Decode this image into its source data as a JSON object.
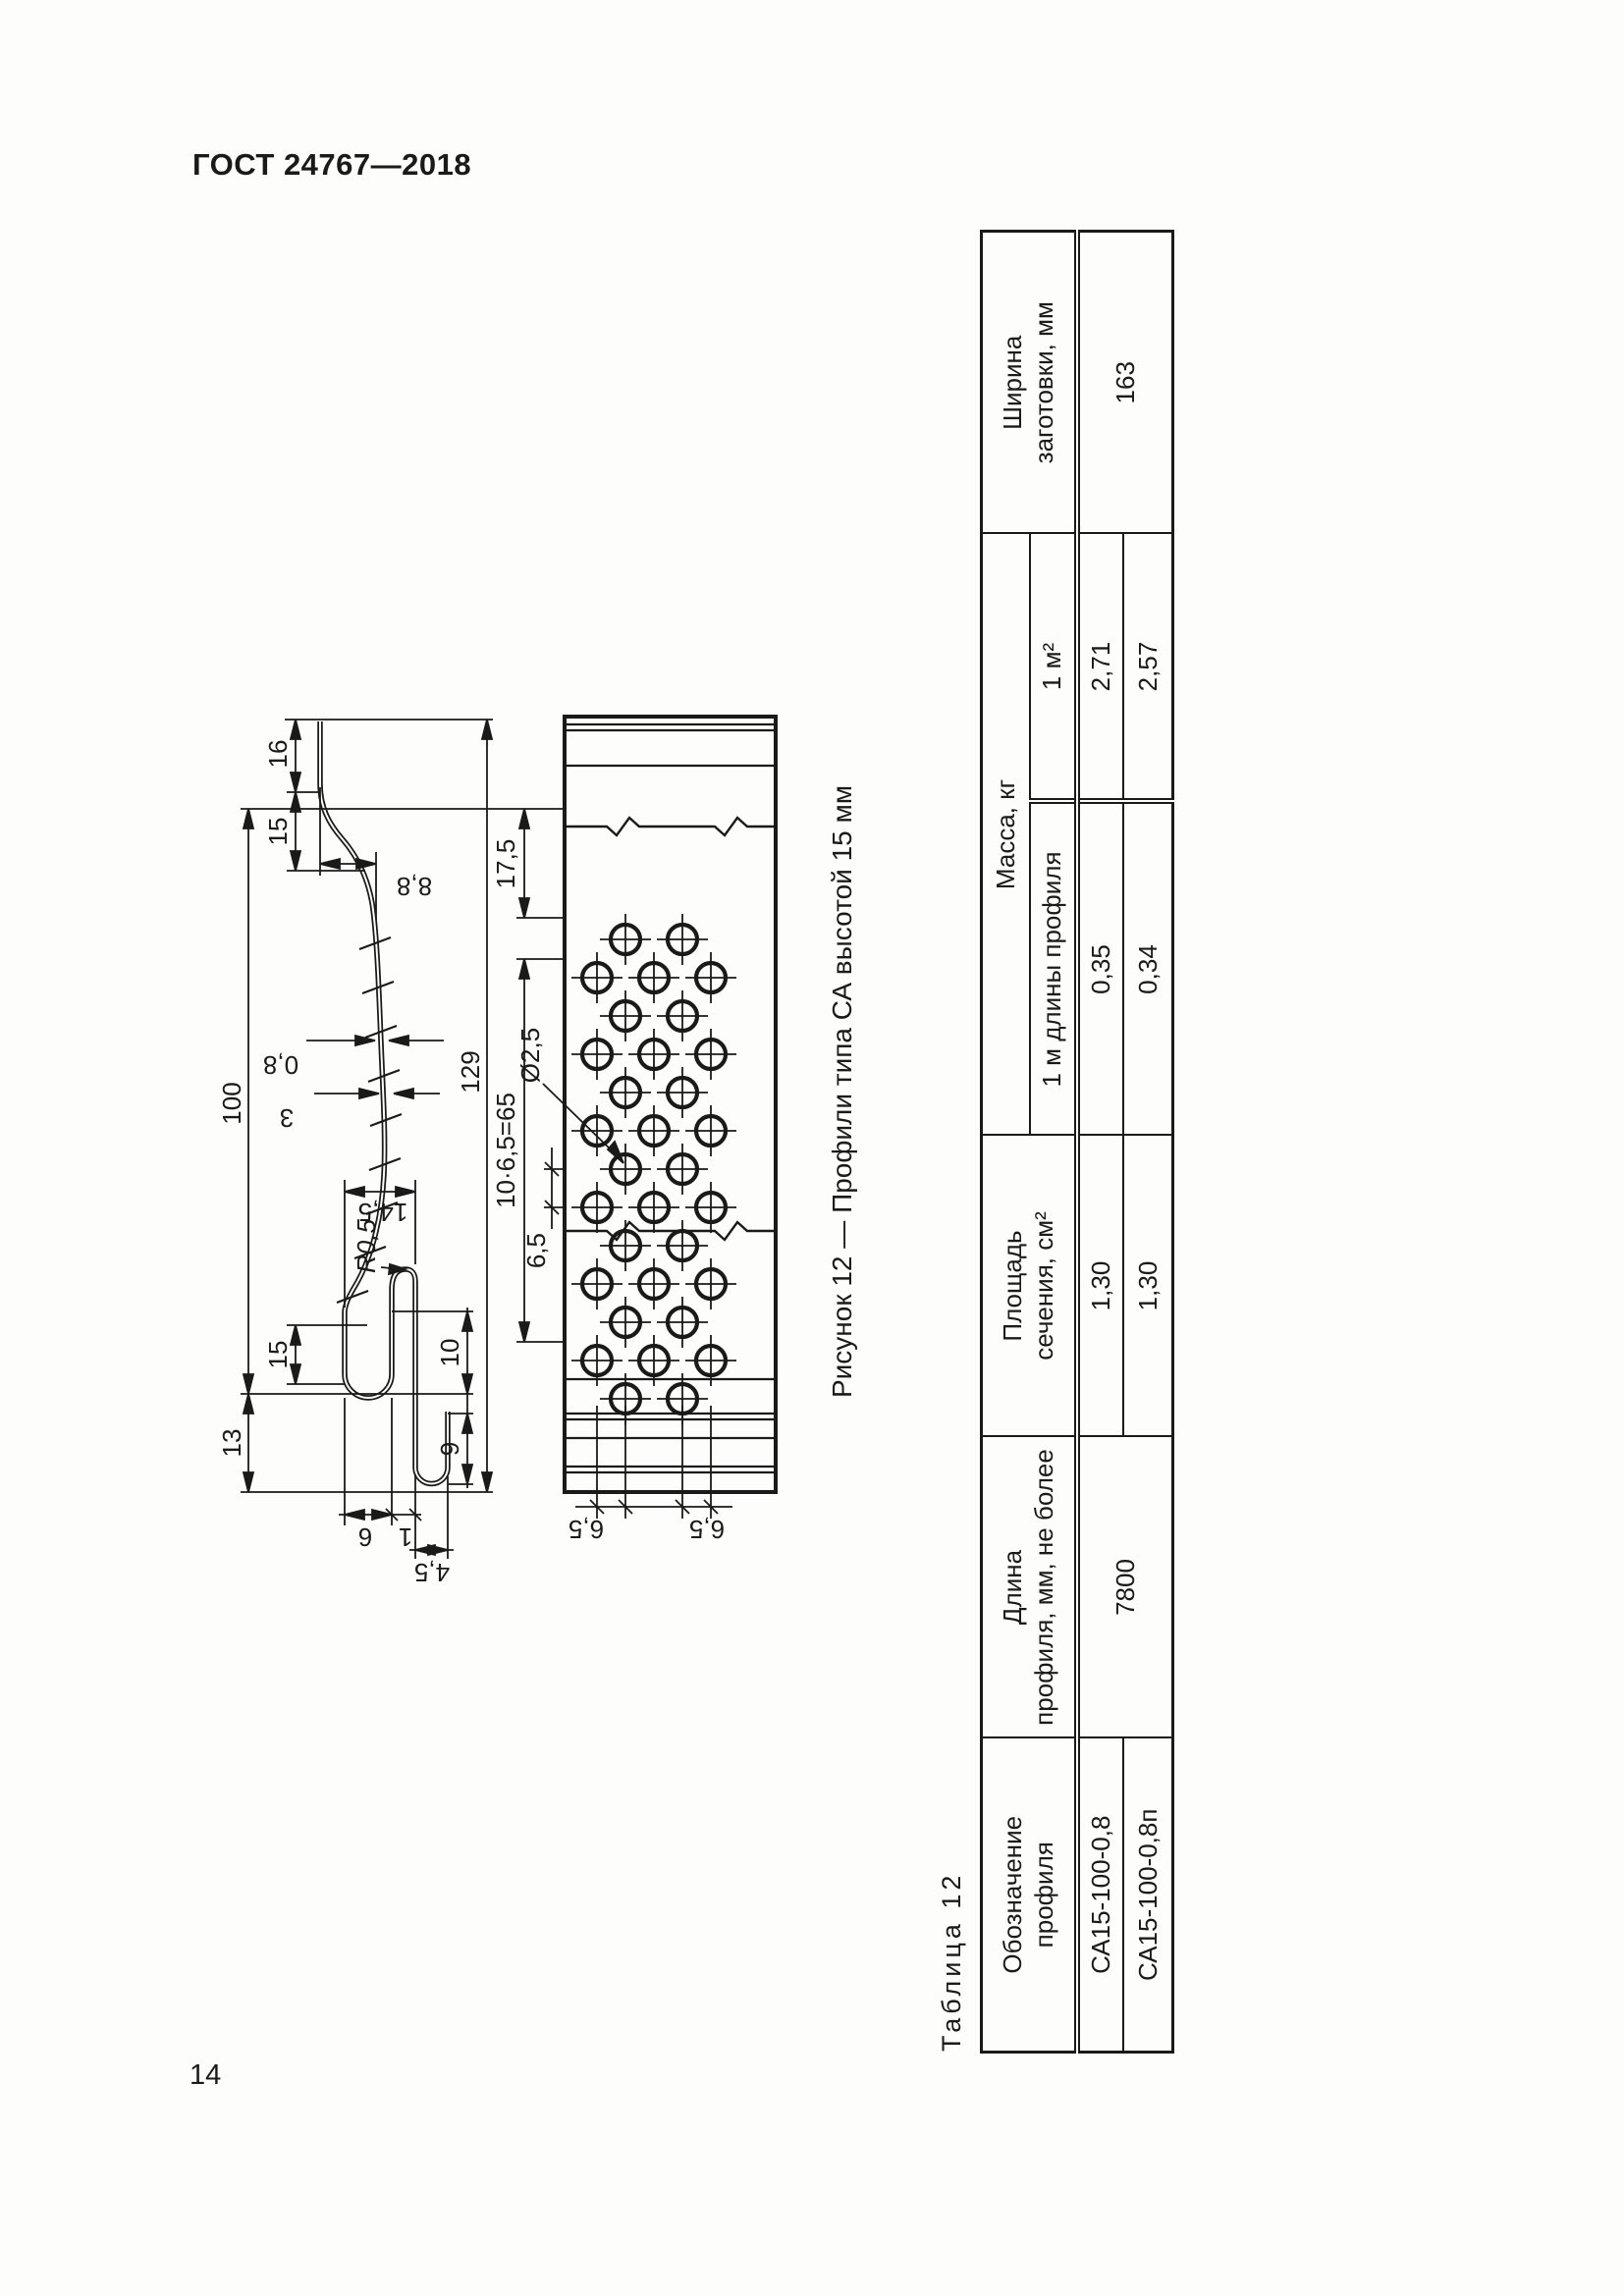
{
  "page": {
    "header": "ГОСТ 24767—2018",
    "page_number": "14"
  },
  "figure": {
    "caption": "Рисунок 12 — Профили типа СА высотой 15 мм",
    "dims": {
      "d13": "13",
      "d100": "100",
      "d15_left": "15",
      "d15_right": "15",
      "d16": "16",
      "d9": "9",
      "d10": "10",
      "d14_5": "14,5",
      "d8_8": "8,8",
      "d0_8": "0,8",
      "d3": "3",
      "dR05": "R0,5",
      "d4_5": "4,5",
      "d6": "6",
      "d1": "1",
      "d129": "129",
      "d17_5": "17,5",
      "d65": "10·6,5=65",
      "d6_5a": "6,5",
      "dia25": "Ø2,5",
      "d6_5L1": "6,5",
      "d6_5L2": "6,5"
    }
  },
  "table": {
    "label": "Таблица 12",
    "headers": {
      "designation": "Обозначение\nпрофиля",
      "length": "Длина\nпрофиля, мм, не более",
      "area": "Площадь\nсечения, см²",
      "mass": "Масса, кг",
      "mass_per_m": "1 м длины профиля",
      "mass_per_m2": "1 м²",
      "width": "Ширина\nзаготовки, мм"
    },
    "rows": [
      {
        "designation": "СА15-100-0,8",
        "length": "7800",
        "area": "1,30",
        "mass_m": "0,35",
        "mass_m2": "2,71",
        "width": "163"
      },
      {
        "designation": "СА15-100-0,8п",
        "area": "1,30",
        "mass_m": "0,34",
        "mass_m2": "2,57"
      }
    ]
  }
}
